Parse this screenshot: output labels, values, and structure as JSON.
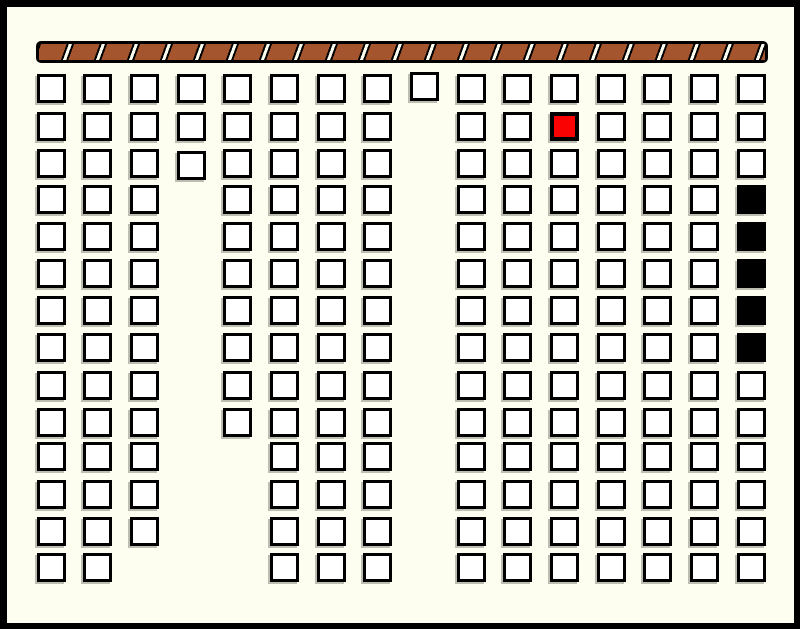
{
  "canvas": {
    "width": 800,
    "height": 629,
    "background": "#FDFDF0",
    "border_color": "#000000",
    "border_width": {
      "top": 7,
      "right": 6,
      "bottom": 6,
      "left": 7
    }
  },
  "bar": {
    "x": 36,
    "y": 41,
    "width": 732,
    "height": 22,
    "fill": "#A5552D",
    "outline": "#000000",
    "separator_color": "#FDFDF0",
    "segment_period_px": 33,
    "stripe_lean": "forward-slash"
  },
  "grid": {
    "square_size": 29,
    "square_border": 3,
    "square_fill": "#FFFFFF",
    "outline": "#000000",
    "shadow_color": "#BDBDB2",
    "red_fill": "#FA0202",
    "black_fill": "#000000",
    "cols": 16,
    "rows": 14,
    "col_x": [
      37,
      83,
      130,
      177,
      223,
      270,
      317,
      363,
      410,
      457,
      503,
      550,
      597,
      643,
      690,
      737
    ],
    "row_y": [
      74,
      112,
      149,
      185,
      222,
      259,
      296,
      333,
      371,
      408,
      442,
      480,
      517,
      553
    ],
    "occupancy": [
      "WWWWWWWWWWWWWWWW",
      "WWWWWWWW.WWRWWWW",
      "WWWWWWWW.WWWWWWW",
      "WWW.WWWW.WWWWWWB",
      "WWW.WWWW.WWWWWWB",
      "WWW.WWWW.WWWWWWB",
      "WWW.WWWW.WWWWWWB",
      "WWW.WWWW.WWWWWWB",
      "WWW.WWWW.WWWWWWW",
      "WWW.WWWW.WWWWWWW",
      "WWW..WWW.WWWWWWW",
      "WWW..WWW.WWWWWWW",
      "WWW..WWW.WWWWWWW",
      "WW...WWW.WWWWWWW"
    ],
    "legend": {
      "W": "white-cell",
      "R": "red-cell",
      "B": "black-cell",
      ".": "empty"
    },
    "offsets": [
      {
        "row": 1,
        "col": 9,
        "dy": -2
      },
      {
        "row": 3,
        "col": 4,
        "dy": 2
      }
    ],
    "counts": {
      "white": 189,
      "red": 1,
      "black": 5,
      "total": 195
    }
  }
}
